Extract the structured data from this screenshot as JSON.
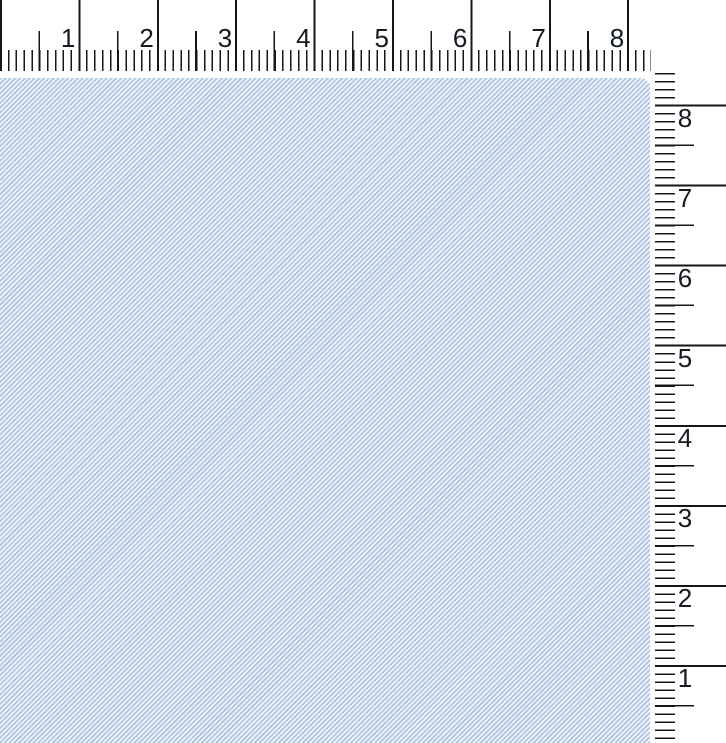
{
  "rulers": {
    "horizontal": {
      "numbers": [
        "1",
        "2",
        "3",
        "4",
        "5",
        "6",
        "7",
        "8"
      ],
      "divisions_per_inch": 10
    },
    "vertical": {
      "numbers": [
        "8",
        "7",
        "6",
        "5",
        "4",
        "3",
        "2",
        "1"
      ],
      "divisions_per_inch": 10
    }
  },
  "swatch": {
    "pattern": "diagonal-twill-weave"
  },
  "colors": {
    "background": "#ffffff",
    "ruler-bg": "#ffffff",
    "tick": "#161616",
    "number": "#121a24",
    "fabric-stripe": "#adc4e0",
    "fabric-light": "#f5f8fc"
  }
}
